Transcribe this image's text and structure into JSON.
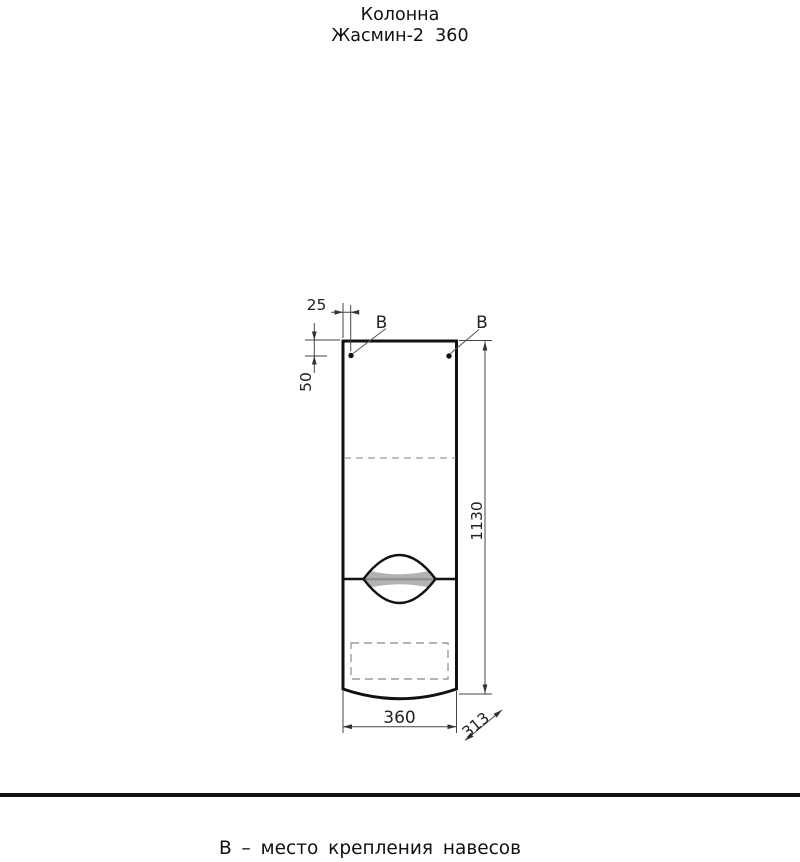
{
  "page": {
    "title_line1": "Колонна",
    "title_line2": "Жасмин-2  360",
    "footer_note": "В – место крепления навесов"
  },
  "drawing": {
    "marker_left": "В",
    "marker_right": "В",
    "dim_hole_offset_horizontal": "25",
    "dim_hole_offset_vertical": "50",
    "dim_height": "1130",
    "dim_width": "360",
    "dim_depth": "313"
  },
  "colors": {
    "outline": "#111111",
    "dimension_lines": "#444444",
    "arrows": "#333333",
    "hidden_lines": "#9c9c9c",
    "handle_fill": "#b3b3b3",
    "background": "#ffffff"
  }
}
